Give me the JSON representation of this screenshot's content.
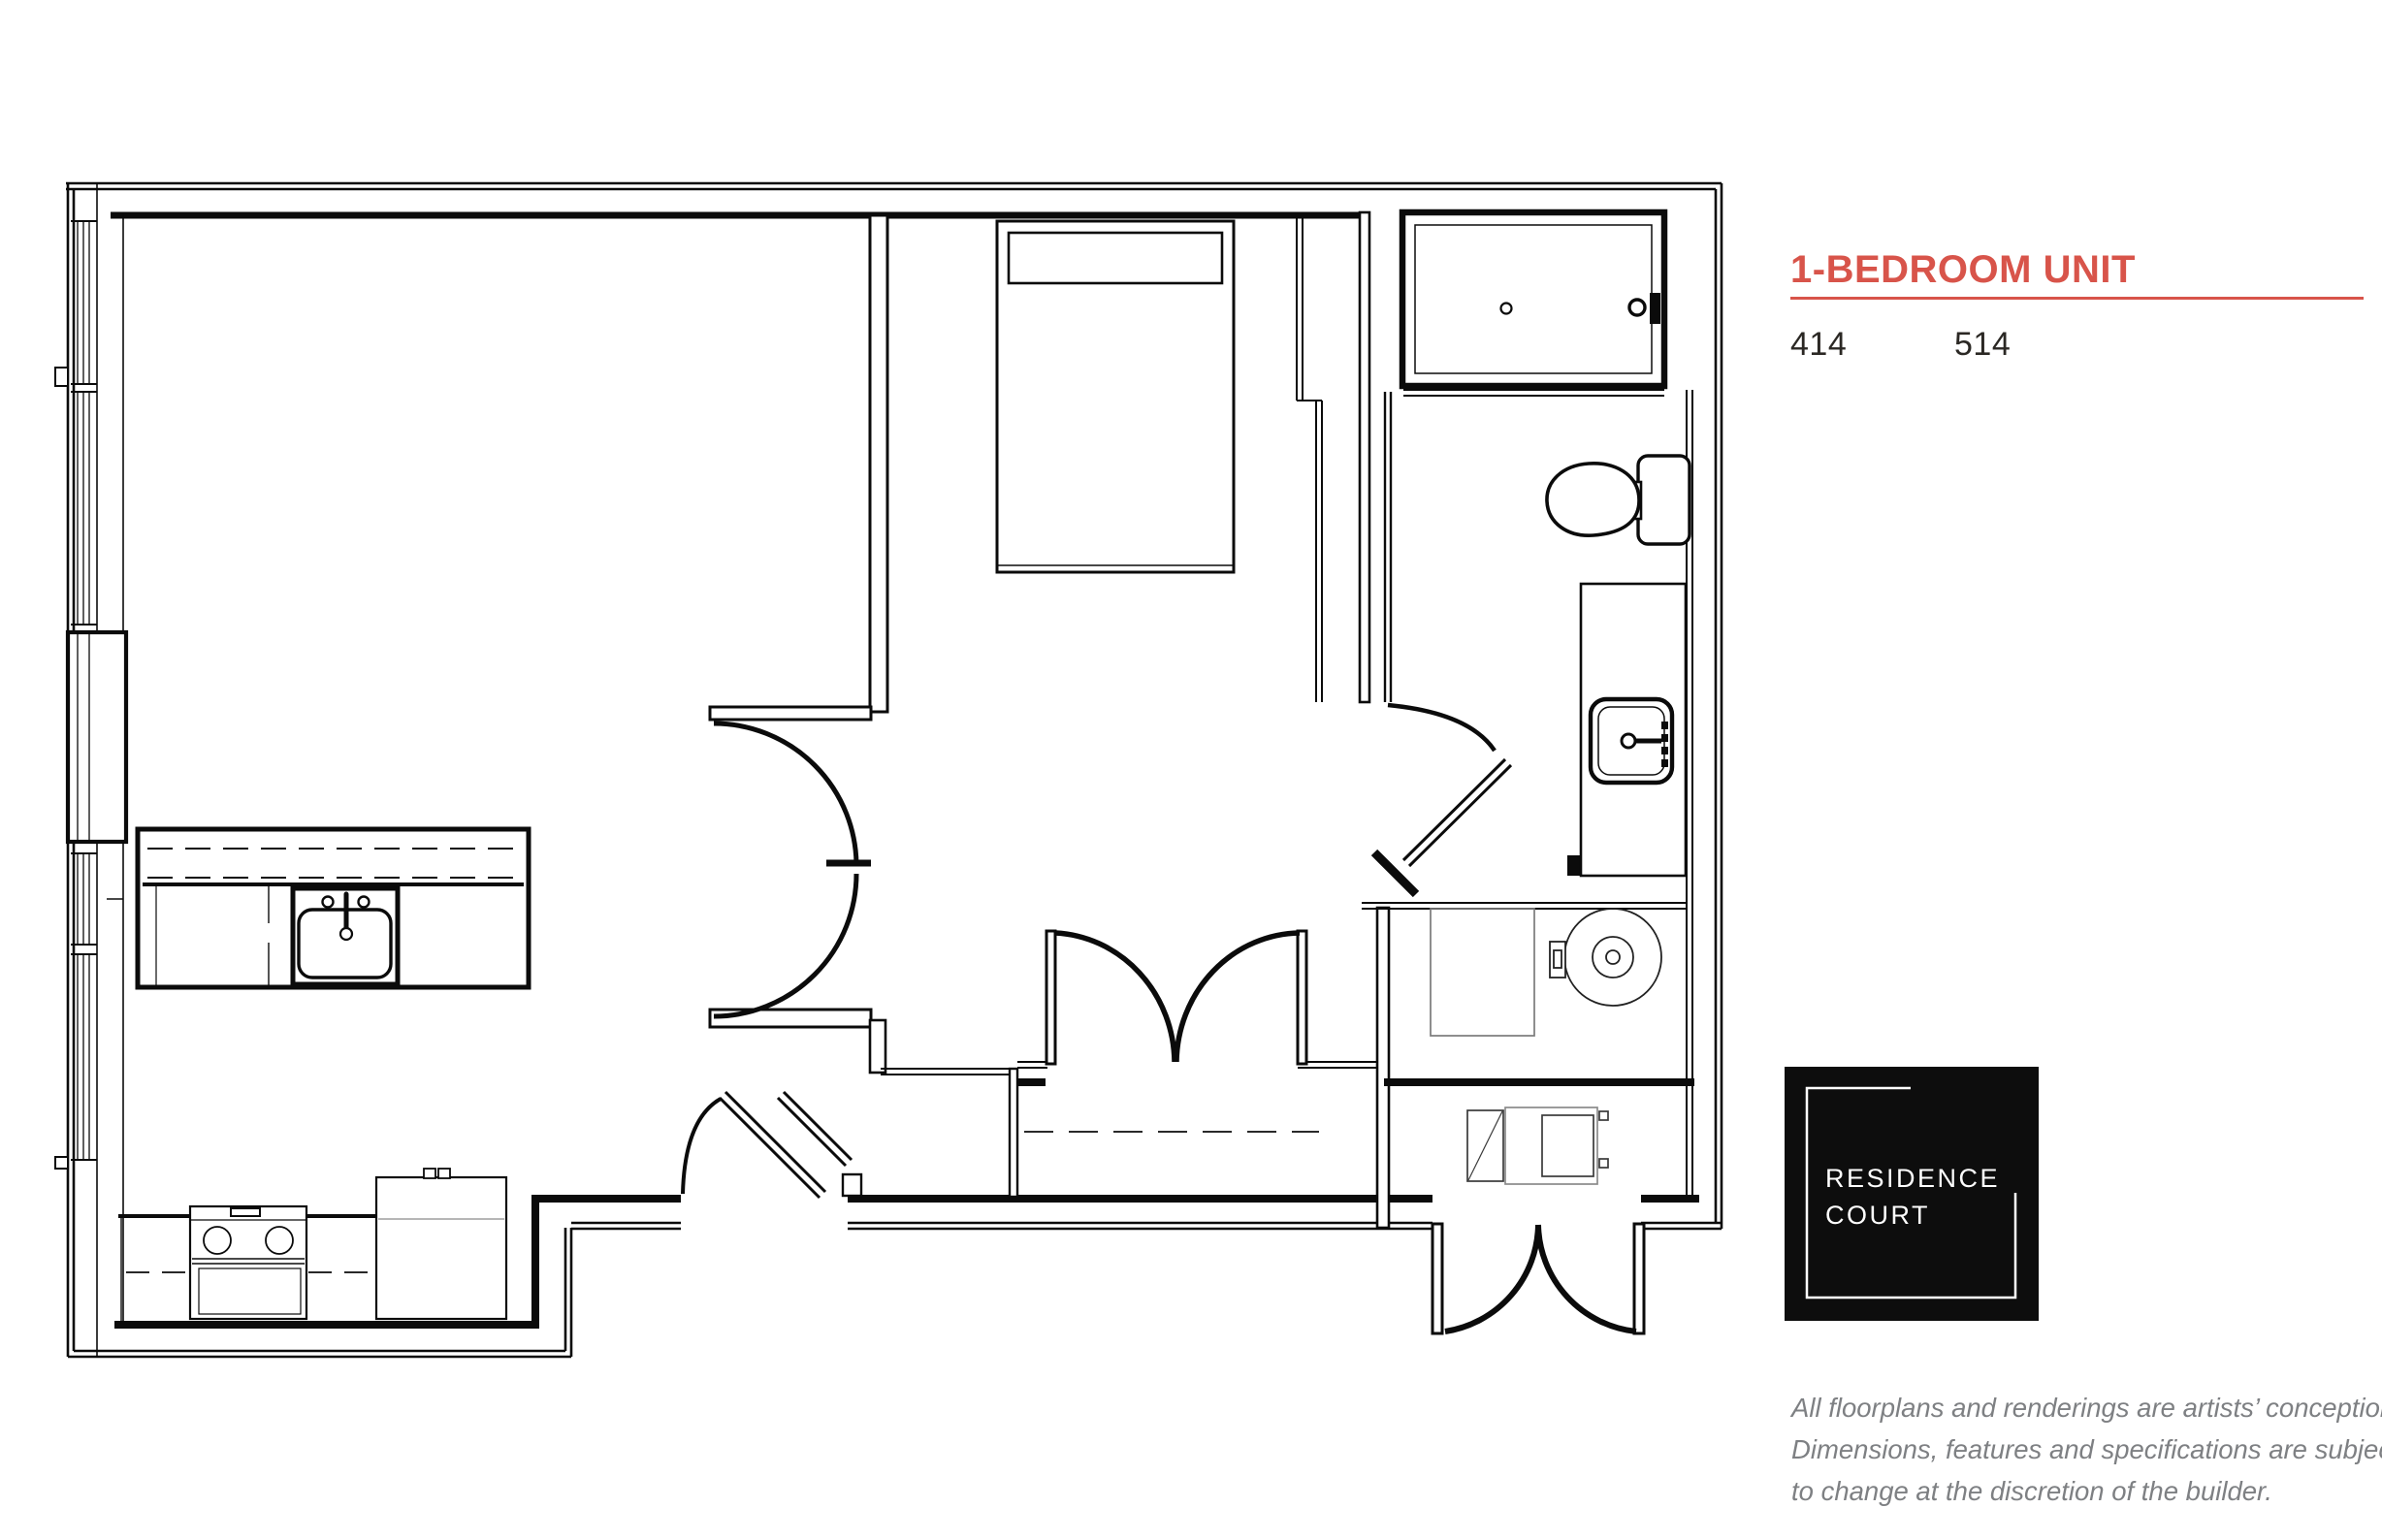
{
  "header": {
    "title": "1-BEDROOM UNIT",
    "unit_numbers": [
      "414",
      "514"
    ],
    "accent_color": "#D8544A"
  },
  "logo": {
    "line1": "RESIDENCE",
    "line2": "COURT",
    "bg_color": "#0D0D0D",
    "text_color": "#FFFFFF"
  },
  "disclaimer": {
    "line1": "All floorplans and renderings are artists’ conception.",
    "line2": "Dimensions, features and specifications are subject",
    "line3": "to change at the discretion of the builder.",
    "text_color": "#7E8083"
  },
  "plan": {
    "ink_color": "#0B0B0B",
    "muted_color": "#7A7A7A",
    "fixtures": [
      "bed",
      "shower",
      "toilet",
      "vanity-sink",
      "washer",
      "dryer",
      "kitchen-island-sink",
      "stove",
      "fridge",
      "entry-bench",
      "closet-rod"
    ]
  }
}
